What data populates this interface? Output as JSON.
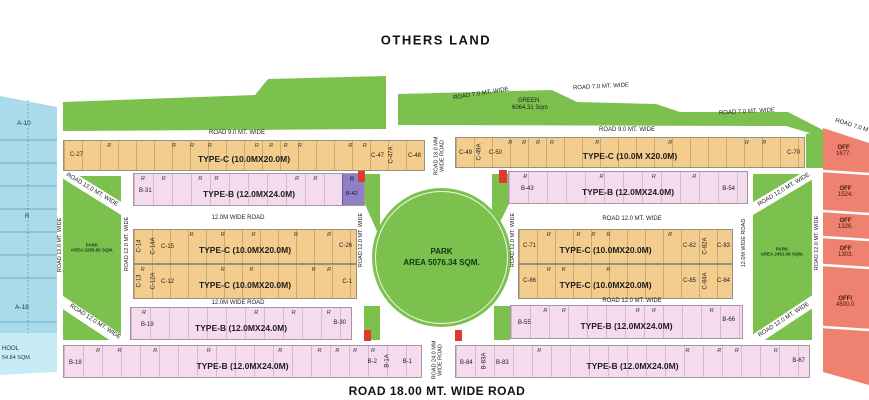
{
  "canvas": {
    "others_land": "OTHERS LAND",
    "bottom_road": "ROAD 18.00 MT. WIDE ROAD"
  },
  "green_band": {
    "green": "GREEN",
    "area": "6064.31 Sqm"
  },
  "roads": {
    "w7": "ROAD 7.0 MT. WIDE",
    "w9": "ROAD 9.0 MT. WIDE",
    "w12": "ROAD 12.0 MT. WIDE",
    "w12alt": "12.0M WIDE ROAD",
    "v18a": "ROAD 18.0 MM",
    "v18b": "WIDE ROAD",
    "v24a": "ROAD 24.0 MM",
    "v24b": "WIDE ROAD"
  },
  "r": "R",
  "left_strip": {
    "a10": "A-10",
    "r": "R",
    "a18": "A-18",
    "school1": "HOOL",
    "school2": "54.84 SQM."
  },
  "right_strip": {
    "plots": [
      {
        "name": "OFF",
        "area": "1677."
      },
      {
        "name": "OFF",
        "area": "1524."
      },
      {
        "name": "OFF",
        "area": "1326."
      },
      {
        "name": "OFF",
        "area": "1303."
      },
      {
        "name": "OFFI",
        "area": "4500.0"
      }
    ]
  },
  "park": {
    "line1": "PARK",
    "line2": "AREA 5076.34 SQM."
  },
  "small_parks": {
    "line1": "PARK",
    "left": "AREA 2285.85 SQM.",
    "right": "AREA 2451.08 SQM."
  },
  "rows": {
    "r1l": {
      "first": "C-27",
      "type": "TYPE-C (10.0MX20.0M)",
      "e1": "C-47",
      "e2": "C-47A",
      "e3": "C-48"
    },
    "r1r": {
      "s1": "C-49",
      "s2": "C-49A",
      "s3": "C-50",
      "type": "TYPE-C (10.0M X20.0M)",
      "last": "C-70"
    },
    "r2l": {
      "first": "B-31",
      "type": "TYPE-B (12.0MX24.0M)",
      "purple": "B-42"
    },
    "r2r": {
      "first": "B-43",
      "type": "TYPE-B (12.0MX24.0M)",
      "last": "B-54"
    },
    "mlA": {
      "s1": "C-14",
      "s2": "C-14A",
      "s3": "C-15",
      "type": "TYPE-C (10.0MX20.0M)",
      "last": "C-26"
    },
    "mlB": {
      "s1": "C-13",
      "s2": "C-12A",
      "s3": "C-12",
      "type": "TYPE-C (10.0MX20.0M)",
      "last": "C-1"
    },
    "mrA": {
      "first": "C-71",
      "type": "TYPE-C (10.0MX20.0M)",
      "e1": "C-82",
      "e2": "C-82A",
      "e3": "C-83"
    },
    "mrB": {
      "first": "C-86",
      "type": "TYPE-C (10.0MX20.0M)",
      "e1": "C-85",
      "e2": "C-84A",
      "e3": "C-84"
    },
    "r5l": {
      "first": "B-19",
      "type": "TYPE-B (12.0MX24.0M)",
      "last": "B-30"
    },
    "r5r": {
      "first": "B-55",
      "type": "TYPE-B (12.0MX24.0M)",
      "last": "B-66"
    },
    "r6l": {
      "first": "B-18",
      "type": "TYPE-B (12.0MX24.0M)",
      "e1": "B-2",
      "e2": "B-1A",
      "e3": "B-1"
    },
    "r6r": {
      "s1": "B-84",
      "s2": "B-83A",
      "s3": "B-83",
      "type": "TYPE-B (12.0MX24.0M)",
      "last": "B-67"
    }
  }
}
